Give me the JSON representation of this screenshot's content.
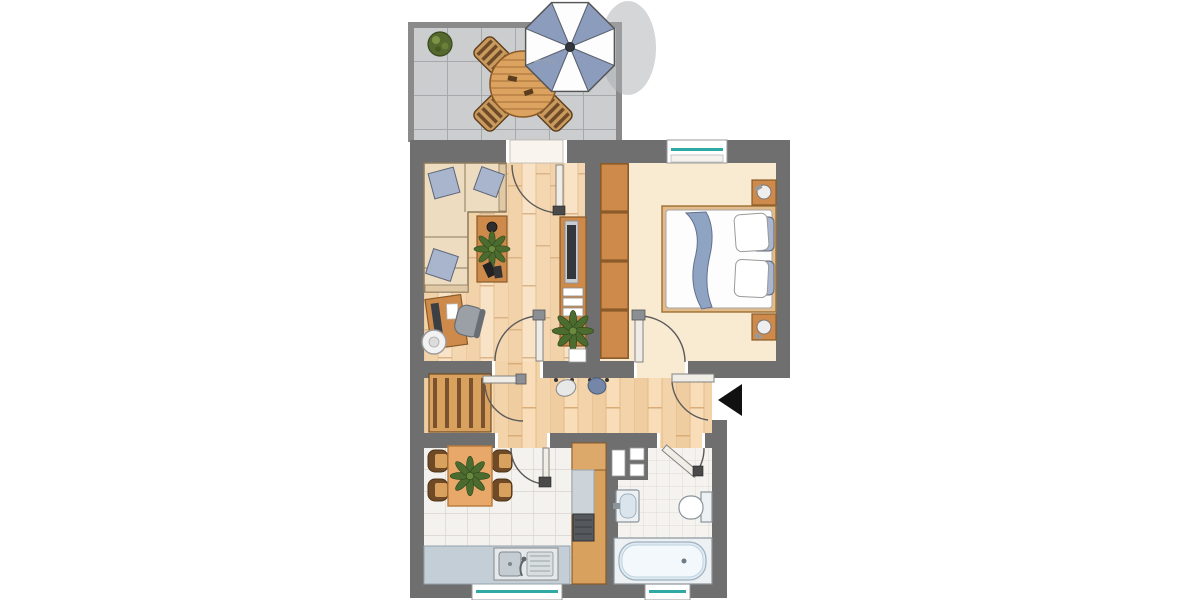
{
  "palette": {
    "wall": "#6f6f6f",
    "wall_light": "#8a8a8a",
    "wood": "#cd8a4a",
    "wood_dark": "#8a5a28",
    "wood_light": "#dda96b",
    "wood_pale": "#d9a15e",
    "wood_slat": "#7a5230",
    "floor_living": "#f6dcbb",
    "floor_bedroom": "#f8ebd2",
    "floor_hall": "#f3d4ad",
    "kitchen_tile": "#f4f2ee",
    "kitchen_tile_line": "#d9d5cd",
    "bath_tile": "#f5f3ef",
    "bath_tile_line": "#e0dbd2",
    "terrace_tile": "#cbcdcf",
    "terrace_tile_line": "#a6a9ab",
    "sofa": "#eddcbf",
    "sofa_line": "#8d7a5d",
    "cushion": "#a9b5cd",
    "cushion_line": "#5c6578",
    "blanket": "#8fa3c2",
    "counter": "#c3ced6",
    "steel": "#c6cdd2",
    "fix": "#eef1f3",
    "fix_line": "#8b949b",
    "glass": "#2fa9a4",
    "umbrella": "#8b9cbd",
    "umbrella_line": "#5d6470",
    "plant_green": "#4c6b2f",
    "plant_green_dark": "#2f4a1d",
    "dark": "#3c4044",
    "leaf": "#f0ede7",
    "leaf_line": "#828282",
    "arc_line": "#5a5a5a",
    "knob": "#4a4a4a",
    "arrow": "#111111"
  },
  "plan": {
    "type": "apartment-floor-plan",
    "rooms": [
      {
        "id": "terrace",
        "furniture": [
          "potted-plant",
          "round-table",
          "chair",
          "chair",
          "chair",
          "chair",
          "parasol"
        ]
      },
      {
        "id": "living-room",
        "furniture": [
          "corner-sofa",
          "cushion",
          "cushion",
          "cushion",
          "coffee-table",
          "bowl",
          "plant",
          "remote",
          "remote",
          "desk",
          "monitor",
          "office-chair",
          "round-chair",
          "tv-sideboard",
          "tv",
          "drawer-unit",
          "plant",
          "wall-niche"
        ]
      },
      {
        "id": "bedroom",
        "furniture": [
          "wardrobe-4-sections",
          "double-bed",
          "blanket",
          "pillow",
          "pillow",
          "pillow",
          "pillow",
          "nightstand",
          "lamp",
          "nightstand",
          "lamp"
        ]
      },
      {
        "id": "hall",
        "furniture": [
          "slatted-wardrobe",
          "coat-hooks",
          "bag",
          "bag"
        ]
      },
      {
        "id": "kitchen",
        "furniture": [
          "dining-table",
          "chair",
          "chair",
          "chair",
          "chair",
          "plant",
          "sink-counter",
          "double-sink",
          "tall-counter",
          "worktop",
          "stove"
        ]
      },
      {
        "id": "bathroom",
        "furniture": [
          "installation-shaft",
          "washbasin",
          "toilet",
          "bathtub"
        ]
      }
    ],
    "openings": {
      "windows": [
        "bedroom-window",
        "kitchen-window",
        "bathroom-window"
      ],
      "doors": [
        "terrace-door",
        "living-room-door",
        "hall-door",
        "kitchen-door",
        "bedroom-door",
        "bathroom-door",
        "entrance-door"
      ],
      "entrance_marker": "black-arrow-left"
    }
  }
}
